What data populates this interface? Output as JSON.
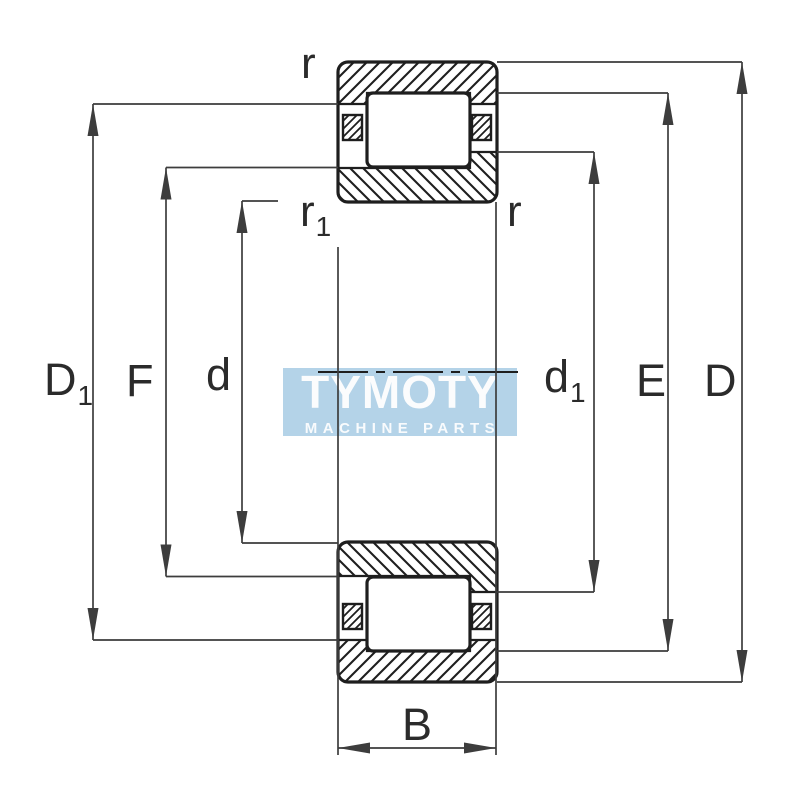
{
  "title": "cylindrical-roller-bearing-dimension-diagram",
  "watermark": {
    "brand": "TYMOTY",
    "tagline": "MACHINE PARTS"
  },
  "labels": {
    "left": [
      {
        "name": "D1",
        "main": "D",
        "sub": "1"
      },
      {
        "name": "F",
        "main": "F",
        "sub": ""
      },
      {
        "name": "d",
        "main": "d",
        "sub": ""
      }
    ],
    "right": [
      {
        "name": "d1",
        "main": "d",
        "sub": "1"
      },
      {
        "name": "E",
        "main": "E",
        "sub": ""
      },
      {
        "name": "D",
        "main": "D",
        "sub": ""
      }
    ],
    "width": {
      "name": "B",
      "main": "B",
      "sub": ""
    },
    "radii": {
      "outer_top": {
        "name": "r",
        "main": "r",
        "sub": ""
      },
      "inner": {
        "name": "r1",
        "main": "r",
        "sub": "1"
      },
      "outer_right": {
        "name": "r",
        "main": "r",
        "sub": ""
      }
    }
  },
  "colors": {
    "background": "#ffffff",
    "outline": "#1e1e1e",
    "dimension_line": "#3d3d3d",
    "label_text": "#2b2b2b",
    "watermark_bg": "#b4d3e8",
    "watermark_text": "#ffffff"
  }
}
